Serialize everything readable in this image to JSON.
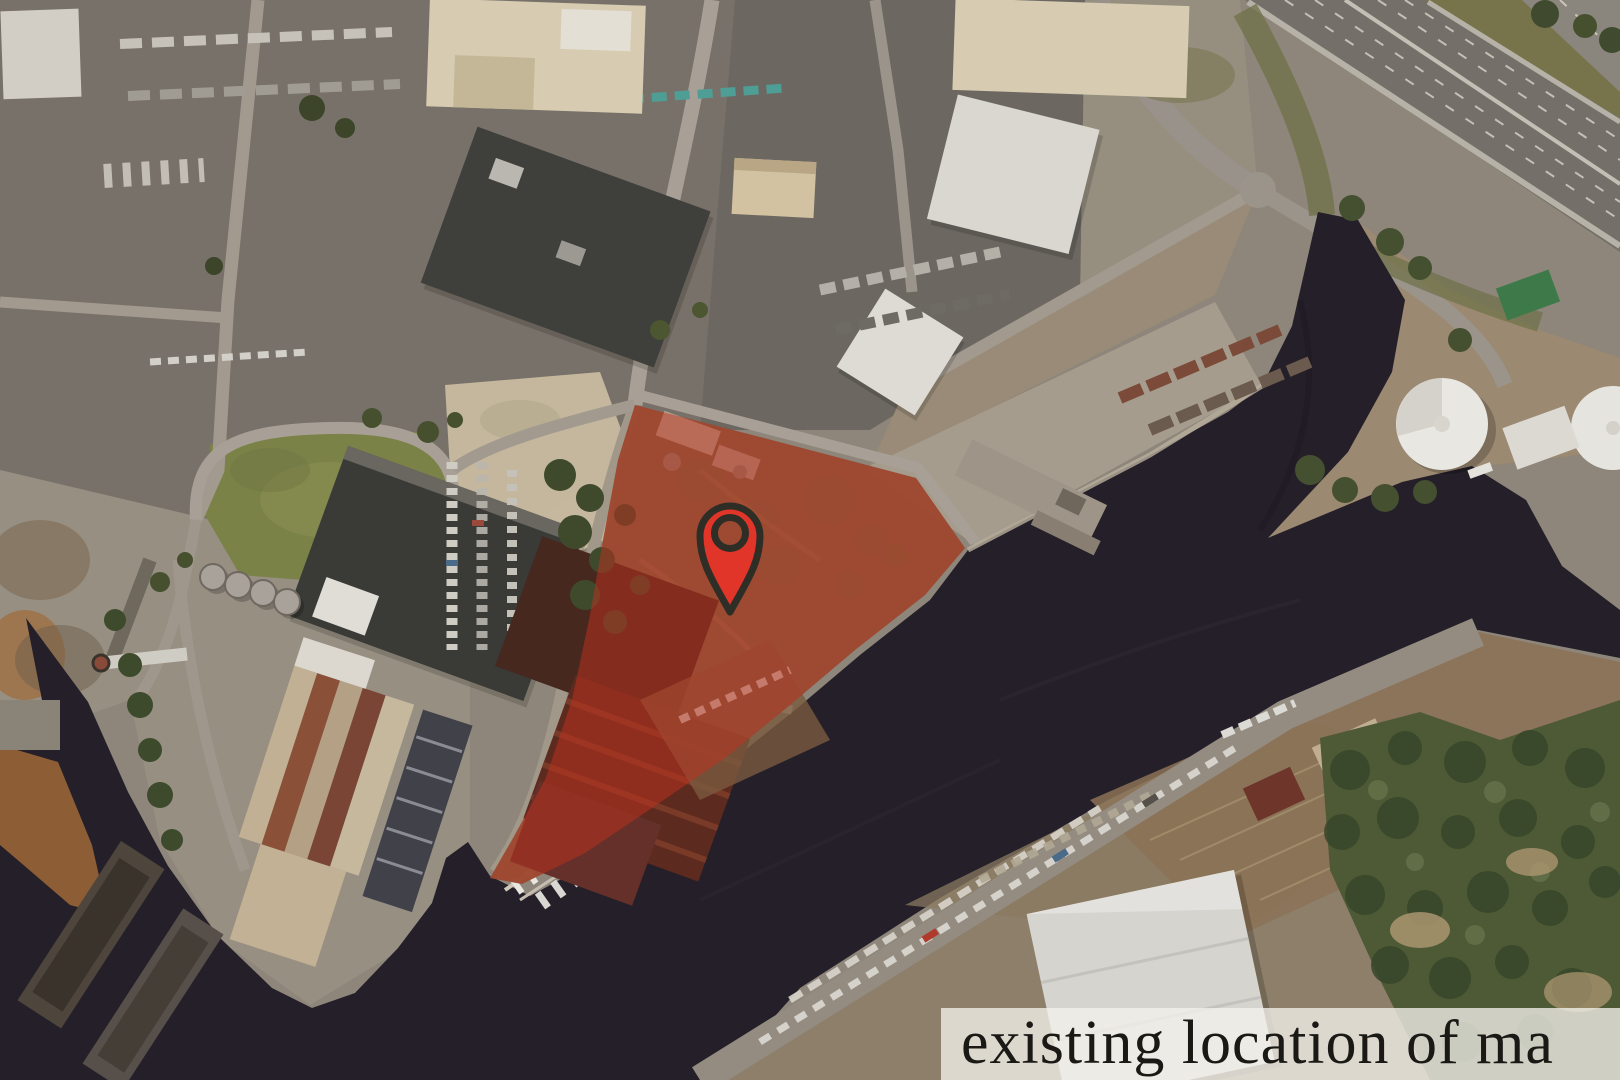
{
  "map": {
    "type": "aerial-satellite-photo",
    "description": "Aerial satellite view of an industrial riverfront district with a highlighted waterfront parcel marked by a red location pin",
    "caption": {
      "text": "existing location of ma",
      "text_color": "#1b1916",
      "background_color": "rgba(243,241,235,0.78)"
    },
    "marker": {
      "icon": "location-pin-icon",
      "fill_color": "#e23529",
      "outline_color": "#2e2e27"
    },
    "site_overlay": {
      "name": "highlighted-site-parcel",
      "fill_color": "#c2301e",
      "fill_opacity": "0.5"
    },
    "water": {
      "fill_color": "#241f28"
    },
    "land": {
      "fill_color": "#8e867a"
    }
  }
}
